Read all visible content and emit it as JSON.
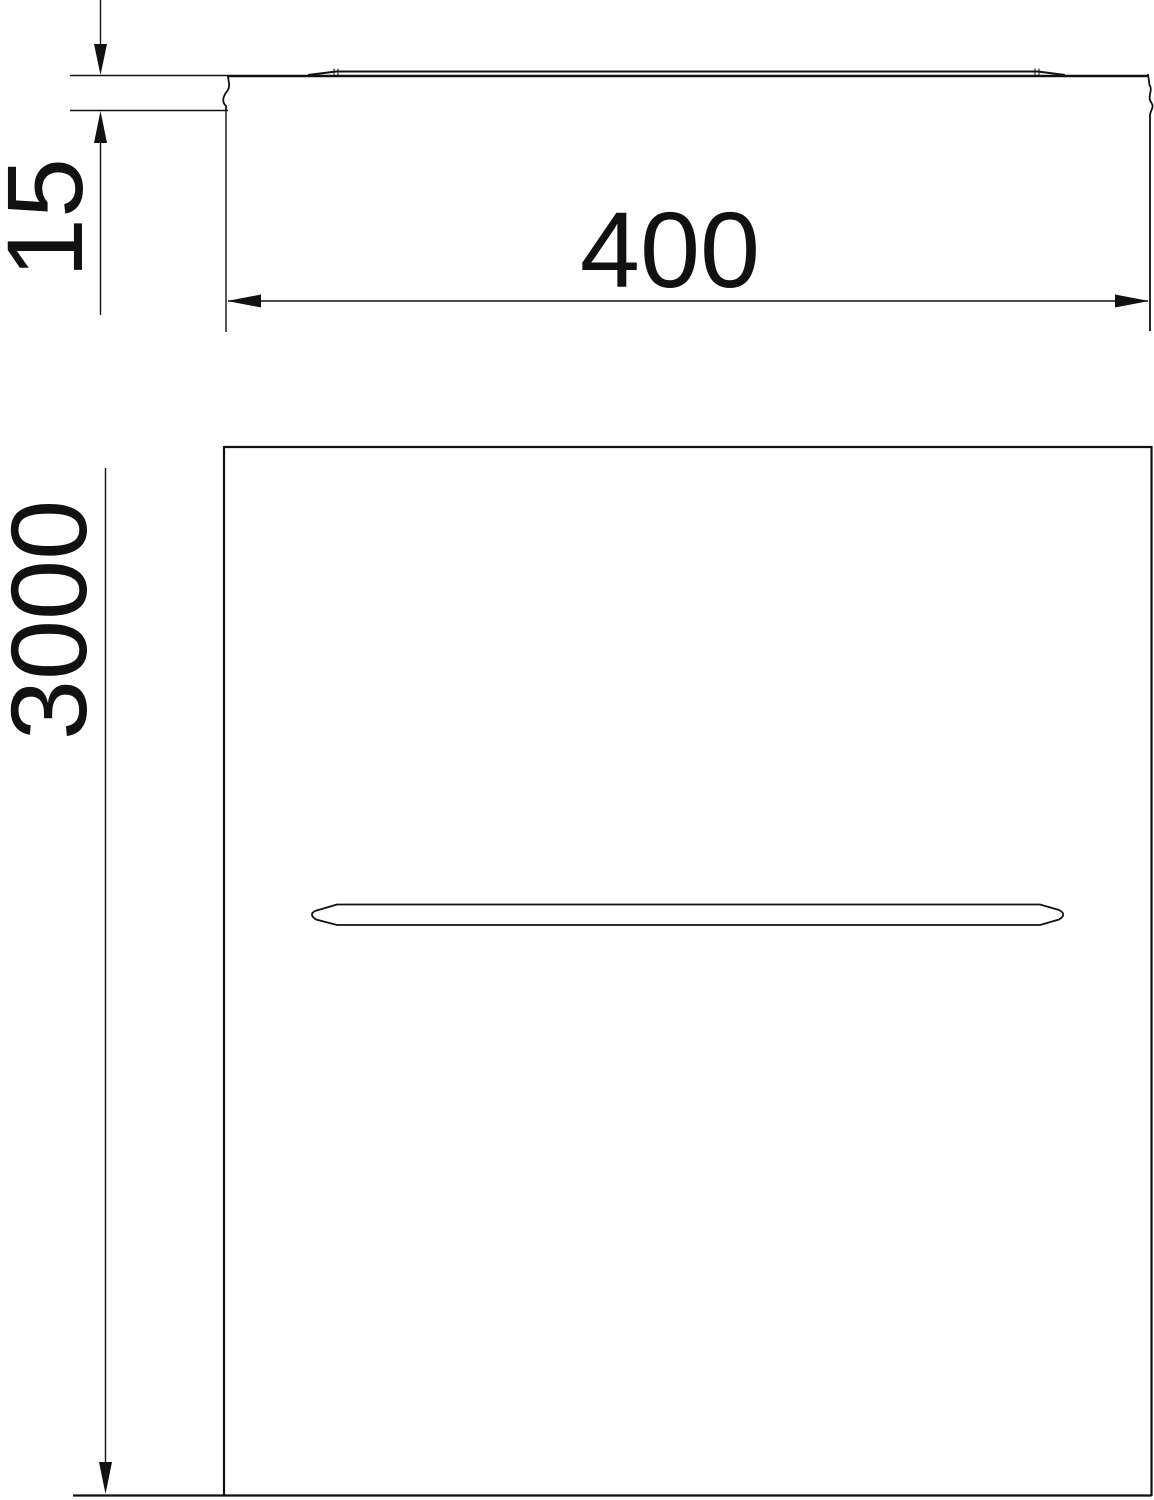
{
  "drawing": {
    "kind": "technical dimension drawing of a cable tray cover (profile view and plan view)",
    "dimensions": {
      "height": {
        "value": "15",
        "orientation": "vertical-rotated-label"
      },
      "width": {
        "value": "400",
        "orientation": "horizontal-label"
      },
      "length": {
        "value": "3000",
        "orientation": "vertical-rotated-label"
      }
    },
    "colors": {
      "line": "#111111",
      "background": "#ffffff"
    }
  }
}
